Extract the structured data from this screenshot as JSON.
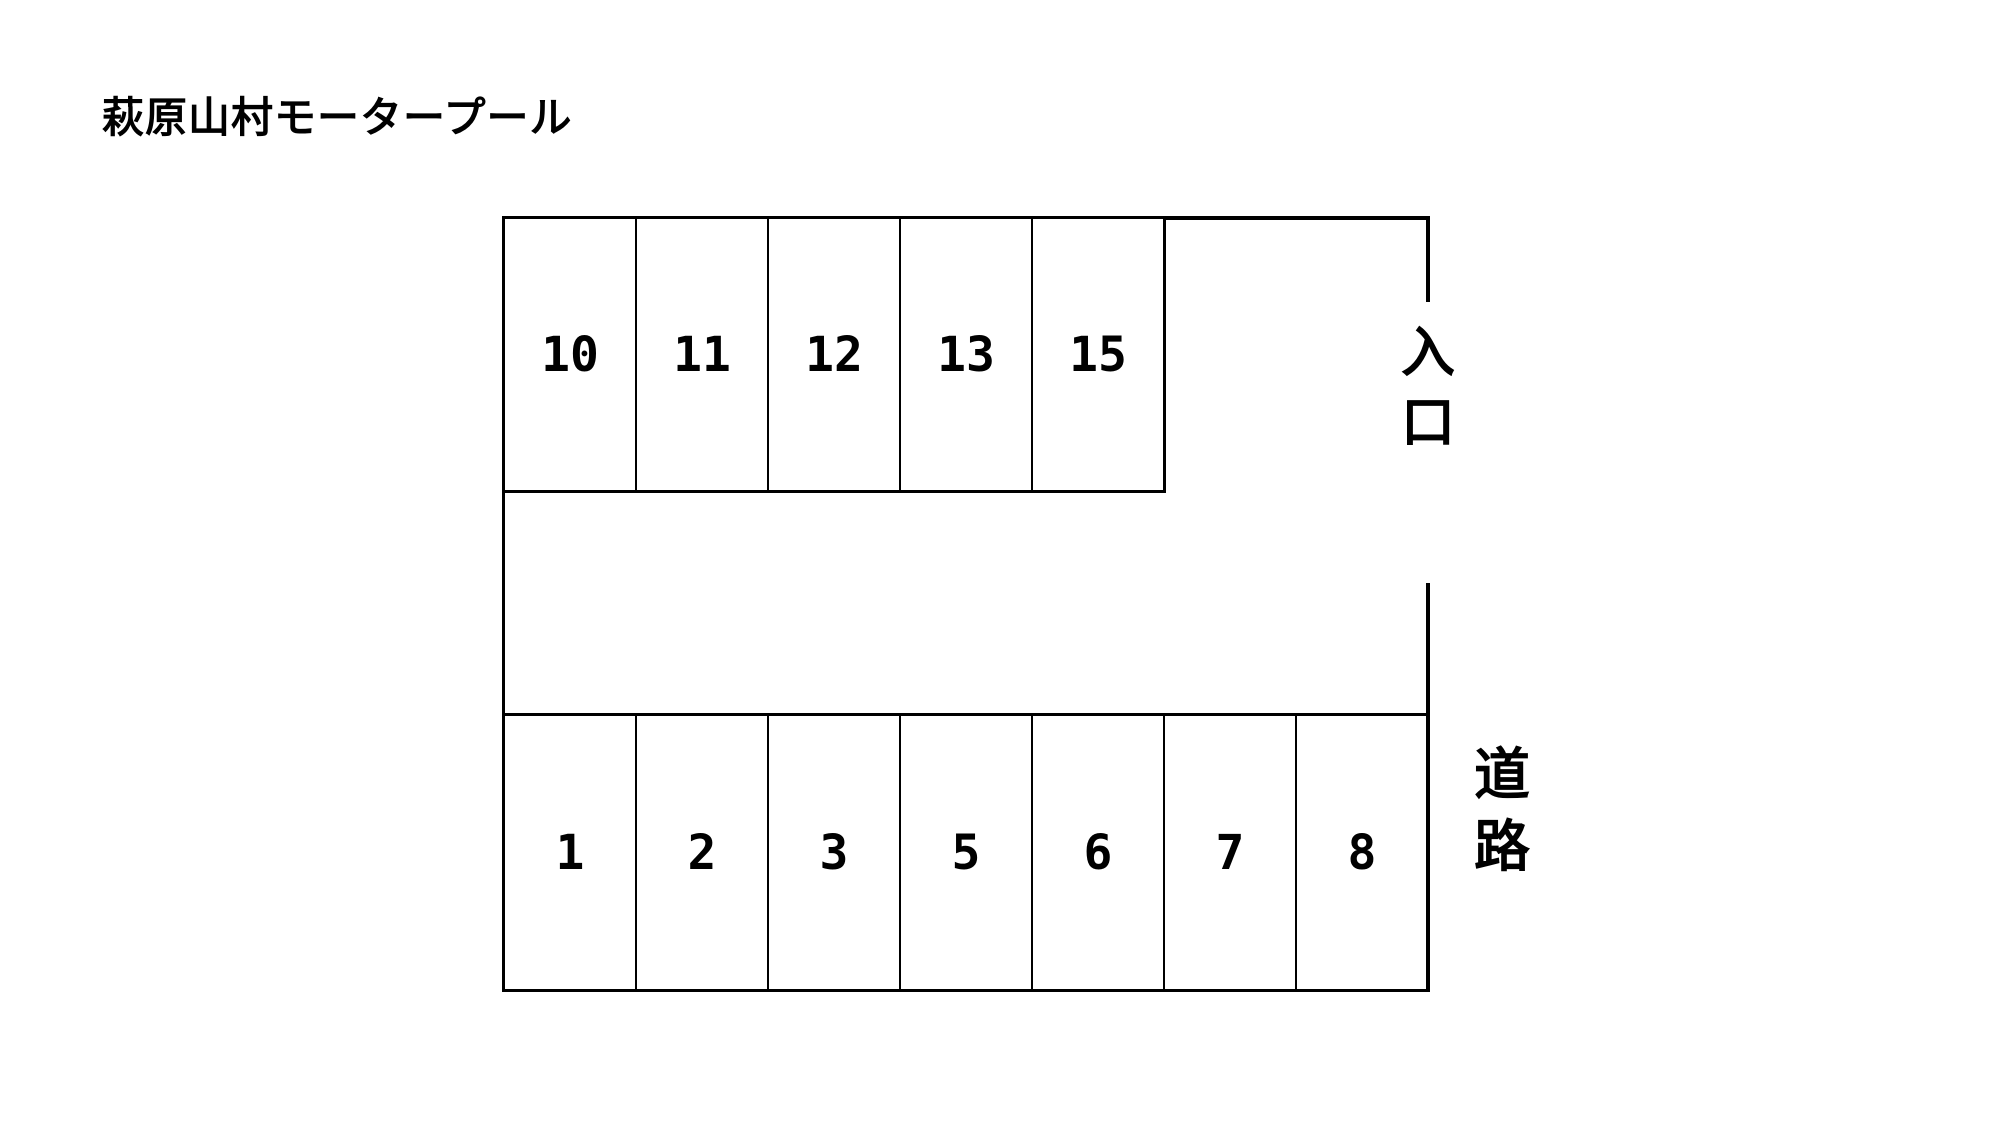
{
  "title": "萩原山村モータープール",
  "colors": {
    "background": "#ffffff",
    "line": "#000000",
    "text": "#000000"
  },
  "lot": {
    "top_row": [
      "10",
      "11",
      "12",
      "13",
      "15"
    ],
    "bottom_row": [
      "1",
      "2",
      "3",
      "5",
      "6",
      "7",
      "8"
    ],
    "entrance_label": "入口",
    "road_label": "道路"
  }
}
